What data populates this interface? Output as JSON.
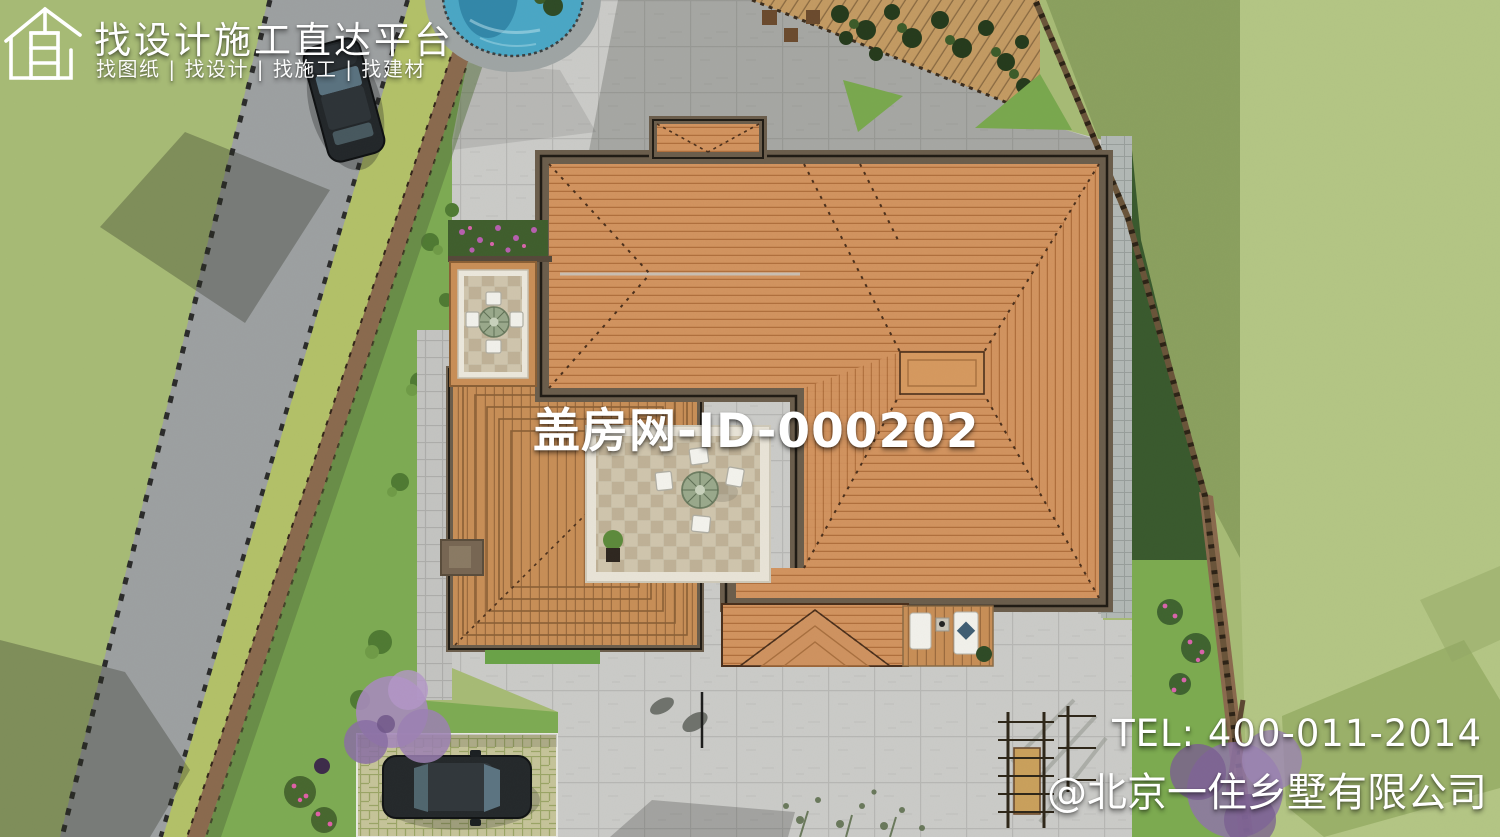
{
  "watermarks": {
    "logo": {
      "icon": "house-outline-icon",
      "title": "找设计施工直达平台",
      "subtitle": "找图纸 | 找设计 | 找施工 | 找建材"
    },
    "center_id": "盖房网-ID-000202",
    "contact": {
      "tel": "TEL: 400-011-2014",
      "company": "@北京一住乡墅有限公司"
    }
  },
  "scene": {
    "description": "aerial top-down rendering of a villa with hip roofs, two inner courtyards with round tables, paved plaza, swimming pool, diagonal road with two cars, parking pad, vine trellis corner and gardens",
    "objects": [
      "road",
      "sidewalk-path",
      "swimming-pool",
      "plaza",
      "main-hip-roof",
      "porch-roof",
      "left-wing-roof",
      "upper-courtyard",
      "lower-courtyard",
      "lounge-deck",
      "parking-pad",
      "car-on-road",
      "parked-car",
      "vine-trellis",
      "boundary-fence",
      "purple-trees",
      "flower-bushes",
      "garden-ladder-structure"
    ]
  },
  "colors": {
    "grass_base": "#a7bb76",
    "grass_light": "#b4c685",
    "grass_shadow": "#8ba05f",
    "road": "#9da0a2",
    "verge": "#b3c169",
    "path_brown": "#8a6a4e",
    "plaza": "#cbcbc9",
    "roof_orange": "#d2935f",
    "eave_brown": "#6b5d4c",
    "pool_blue": "#3f9cbf",
    "deck_wood": "#c88e57",
    "courtyard_tile": "#d0c5ae",
    "watermark_text": "#ffffff"
  }
}
